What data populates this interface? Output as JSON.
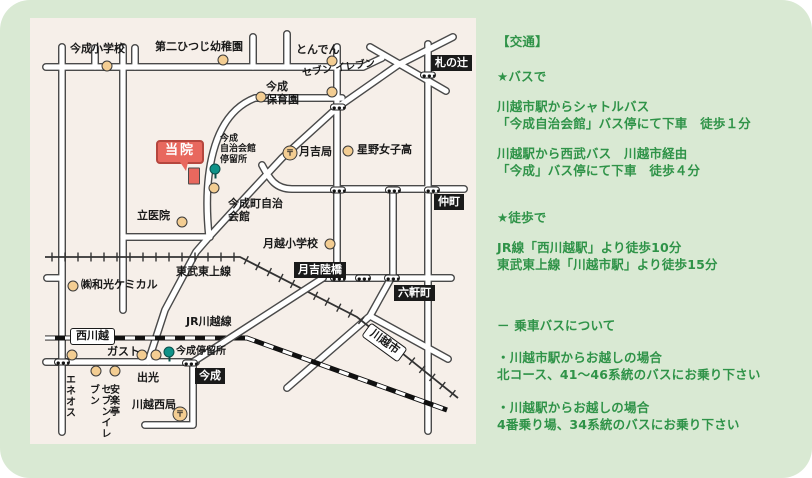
{
  "colors": {
    "background_green": "#d9e9d3",
    "map_background": "#f6efe9",
    "text_green": "#2f9348",
    "clinic_red": "#e8685e",
    "poi_beige": "#f3cd92",
    "bus_stop_teal": "#0f9288"
  },
  "map": {
    "labels": [
      {
        "name": "label-imanari-elementary",
        "text": "今成小学校",
        "cls": "t",
        "x": 40,
        "y": 25
      },
      {
        "name": "label-daini-hitsuji-kindergarten",
        "text": "第二ひつじ幼稚園",
        "cls": "t",
        "x": 125,
        "y": 23
      },
      {
        "name": "label-tonden",
        "text": "とんでん",
        "cls": "t",
        "x": 266,
        "y": 26
      },
      {
        "name": "label-fudanotsuji",
        "text": "札の辻",
        "cls": "bk",
        "x": 401,
        "y": 37
      },
      {
        "name": "label-imanari-hoikuen",
        "text": "今成\n保育園",
        "cls": "t",
        "x": 236,
        "y": 63
      },
      {
        "name": "label-seven-eleven-north",
        "text": "セブン\nイレブン",
        "cls": "sm10",
        "x": 272,
        "y": 45,
        "rot": -8
      },
      {
        "name": "label-tsukiyoshi-post-office",
        "text": "月吉局",
        "cls": "t",
        "x": 269,
        "y": 128
      },
      {
        "name": "label-hoshino-girls-high",
        "text": "星野女子高",
        "cls": "t",
        "x": 327,
        "y": 126
      },
      {
        "name": "label-nakacho",
        "text": "仲町",
        "cls": "bk",
        "x": 404,
        "y": 176
      },
      {
        "name": "label-bus-stop-imanari-jichikaikan",
        "text": "今成\n自治会館\n停留所",
        "cls": "sm",
        "x": 190,
        "y": 116
      },
      {
        "name": "label-imanari-cho-hall",
        "text": "今成町自治\n会館",
        "cls": "t",
        "x": 198,
        "y": 180
      },
      {
        "name": "label-clinic",
        "text": "当院",
        "cls": "clinic",
        "x": 126,
        "y": 122
      },
      {
        "name": "label-tachi-clinic",
        "text": "立医院",
        "cls": "t",
        "x": 107,
        "y": 192
      },
      {
        "name": "label-tsukigoe-elementary",
        "text": "月越小学校",
        "cls": "t",
        "x": 233,
        "y": 220
      },
      {
        "name": "label-tsukiyoshi-overpass",
        "text": "月吉陸橋",
        "cls": "bk",
        "x": 264,
        "y": 244
      },
      {
        "name": "label-rokkencho",
        "text": "六軒町",
        "cls": "bk",
        "x": 364,
        "y": 267
      },
      {
        "name": "label-tobu-tojo-line",
        "text": "東武東上線",
        "cls": "t",
        "x": 146,
        "y": 248
      },
      {
        "name": "label-wako-chemical",
        "text": "㈱和光ケミカル",
        "cls": "t",
        "x": 51,
        "y": 261
      },
      {
        "name": "label-jr-kawagoe-line",
        "text": "JR川越線",
        "cls": "t",
        "x": 156,
        "y": 298
      },
      {
        "name": "label-nishi-kawagoe-station",
        "text": "西川越",
        "cls": "wt",
        "x": 40,
        "y": 310
      },
      {
        "name": "label-kawagoe-shi-station",
        "text": "川越市",
        "cls": "wt",
        "x": 332,
        "y": 316,
        "rot": 36
      },
      {
        "name": "label-gasto",
        "text": "ガスト",
        "cls": "t",
        "x": 77,
        "y": 328
      },
      {
        "name": "label-bus-stop-imanari",
        "text": "今成停留所",
        "cls": "sm10",
        "x": 146,
        "y": 328
      },
      {
        "name": "label-imanari",
        "text": "今成",
        "cls": "bk",
        "x": 165,
        "y": 350
      },
      {
        "name": "label-idemitsu",
        "text": "出光",
        "cls": "t",
        "x": 107,
        "y": 354
      },
      {
        "name": "label-eneos",
        "text": "エネオス",
        "cls": "vert",
        "x": 33,
        "y": 356
      },
      {
        "name": "label-seven-eleven-south",
        "text": "セブンイレブン",
        "cls": "vert",
        "x": 57,
        "y": 366
      },
      {
        "name": "label-anrakutei",
        "text": "安楽亭",
        "cls": "vert",
        "x": 77,
        "y": 366
      },
      {
        "name": "label-kawagoe-nishi-post-office",
        "text": "川越西局",
        "cls": "t",
        "x": 102,
        "y": 381
      }
    ],
    "markers": [
      {
        "name": "poi-imanari-elementary",
        "type": "poi",
        "x": 77,
        "y": 48
      },
      {
        "name": "poi-daini-hitsuji",
        "type": "poi",
        "x": 193,
        "y": 42
      },
      {
        "name": "poi-tonden",
        "type": "poi",
        "x": 302,
        "y": 43
      },
      {
        "name": "poi-imanari-hoikuen",
        "type": "poi",
        "x": 231,
        "y": 79
      },
      {
        "name": "poi-seven-eleven-north",
        "type": "poi",
        "x": 302,
        "y": 74
      },
      {
        "name": "post-office-tsukiyoshi",
        "type": "post",
        "x": 260,
        "y": 135,
        "glyph": "〒"
      },
      {
        "name": "poi-hoshino-girls-high",
        "type": "poi",
        "x": 318,
        "y": 133
      },
      {
        "name": "bus-stop-imanari-jichikaikan",
        "type": "bus",
        "x": 185,
        "y": 151
      },
      {
        "name": "poi-imanari-cho-hall",
        "type": "poi",
        "x": 184,
        "y": 170
      },
      {
        "name": "clinic-building",
        "type": "bldg",
        "x": 164,
        "y": 158
      },
      {
        "name": "poi-tachi-clinic",
        "type": "poi",
        "x": 152,
        "y": 204
      },
      {
        "name": "poi-tsukigoe-elementary",
        "type": "poi",
        "x": 300,
        "y": 226
      },
      {
        "name": "poi-wako-chemical",
        "type": "poi",
        "x": 43,
        "y": 268
      },
      {
        "name": "poi-gasto",
        "type": "poi",
        "x": 112,
        "y": 337
      },
      {
        "name": "poi-idemitsu",
        "type": "poi",
        "x": 126,
        "y": 337
      },
      {
        "name": "bus-stop-imanari",
        "type": "bus",
        "x": 139,
        "y": 334
      },
      {
        "name": "poi-eneos",
        "type": "poi",
        "x": 42,
        "y": 337
      },
      {
        "name": "poi-seven-eleven-south",
        "type": "poi",
        "x": 66,
        "y": 353
      },
      {
        "name": "poi-anrakutei",
        "type": "poi",
        "x": 85,
        "y": 353
      },
      {
        "name": "post-office-kawagoe-nishi",
        "type": "post",
        "x": 150,
        "y": 396,
        "glyph": "〒"
      },
      {
        "name": "signal-fudanotsuji",
        "type": "signal",
        "x": 398,
        "y": 57
      },
      {
        "name": "signal-tonden-diagonal",
        "type": "signal",
        "x": 308,
        "y": 89
      },
      {
        "name": "signal-nakacho-1",
        "type": "signal",
        "x": 308,
        "y": 172
      },
      {
        "name": "signal-nakacho-2",
        "type": "signal",
        "x": 363,
        "y": 172
      },
      {
        "name": "signal-nakacho-3",
        "type": "signal",
        "x": 402,
        "y": 172
      },
      {
        "name": "signal-rokkencho-1",
        "type": "signal",
        "x": 308,
        "y": 260
      },
      {
        "name": "signal-rokkencho-2",
        "type": "signal",
        "x": 333,
        "y": 260
      },
      {
        "name": "signal-rokkencho-3",
        "type": "signal",
        "x": 362,
        "y": 260
      },
      {
        "name": "signal-nishi-kawagoe",
        "type": "signal",
        "x": 32,
        "y": 344
      },
      {
        "name": "signal-imanari",
        "type": "signal",
        "x": 160,
        "y": 345
      }
    ]
  },
  "transport": {
    "paragraphs": [
      {
        "name": "transport-heading",
        "text": "【交通】",
        "mt": 0
      },
      {
        "name": "bus-section-heading",
        "text": "★バスで",
        "mt": 18
      },
      {
        "name": "bus-route-shuttle",
        "text": "川越市駅からシャトルバス\n「今成自治会館」バス停にて下車　徒歩１分",
        "mt": 13
      },
      {
        "name": "bus-route-seibu",
        "text": "川越駅から西武バス　川越市経由\n「今成」バス停にて下車　徒歩４分",
        "mt": 13
      },
      {
        "name": "walk-section-heading",
        "text": "★徒歩で",
        "mt": 30
      },
      {
        "name": "walk-routes",
        "text": "JR線「西川越駅」より徒歩10分\n東武東上線「川越市駅」より徒歩15分",
        "mt": 13
      },
      {
        "name": "bus-info-heading",
        "text": "－ 乗車バスについて",
        "mt": 44
      },
      {
        "name": "bus-info-kawagoeshi",
        "text": "・川越市駅からお越しの場合\n北コース、41～46系統のバスにお乗り下さい",
        "mt": 15
      },
      {
        "name": "bus-info-kawagoe",
        "text": "・川越駅からお越しの場合\n4番乗り場、34系統のバスにお乗り下さい",
        "mt": 16
      }
    ]
  }
}
